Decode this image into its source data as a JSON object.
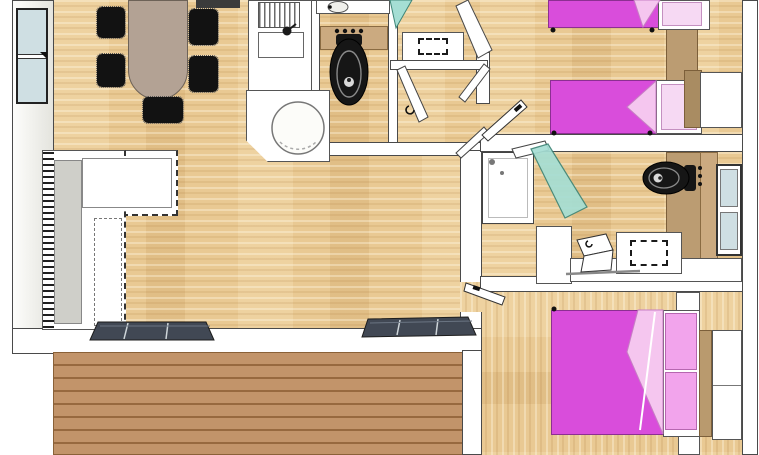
{
  "title": "mobile-home-floor-plan",
  "palette": {
    "floor_wood": "#e9c993",
    "deck_wood": "#c2946a",
    "deck_line": "#97693f",
    "wall_fill": "#ffffff",
    "wall_line": "#4a4a4a",
    "exterior_wall_gray": "#e4e4de",
    "window_glass": "#cfdfe3",
    "bed_magenta": "#d94ddb",
    "bed_fold_pink": "#f5c6ef",
    "pillow_pink": "#f2a4ec",
    "pillow_pale": "#f6d9f3",
    "shower_glass_teal": "#a5ded4",
    "toilet_black": "#161616",
    "table_taupe": "#b3a294",
    "chair_black": "#121212",
    "sofa_gray": "#cfcfc9",
    "mat_dark": "#414854",
    "cabinet_tan": "#bb9c72",
    "counter_tan": "#cbaa80"
  },
  "rooms": [
    "living-dining-area",
    "kitchen",
    "wc-toilet-room",
    "entry-hall",
    "twin-bedroom",
    "family-bathroom",
    "master-bedroom",
    "deck-terrace"
  ],
  "fixtures": {
    "living_dining": [
      "oval-dining-table",
      "five-black-chairs",
      "l-shaped-corner-sofa",
      "left-wall-window",
      "two-sliding-door-mats"
    ],
    "kitchen": [
      "sink-with-drainer",
      "faucet",
      "corner-unit-with-round-appliance",
      "counter"
    ],
    "wc": [
      "black-toilet",
      "washbasin",
      "tan-counter",
      "flush-buttons"
    ],
    "entry_hall": [
      "teal-front-door",
      "storage-cabinet-dashed",
      "interior-door-leaves"
    ],
    "twin_bedroom": [
      "single-bed-1-magenta",
      "single-bed-2-magenta",
      "white-wardrobe",
      "tan-dresser-band",
      "door-leaf"
    ],
    "bathroom": [
      "shower-tray",
      "teal-glass-shower-door",
      "black-toilet",
      "vanity-unit-dashed",
      "open-lid-fixture",
      "right-wall-window"
    ],
    "master_bedroom": [
      "double-bed-magenta",
      "two-pink-pillows",
      "tan-headboard",
      "white-wardrobe",
      "nightstands",
      "door-leaf"
    ]
  }
}
